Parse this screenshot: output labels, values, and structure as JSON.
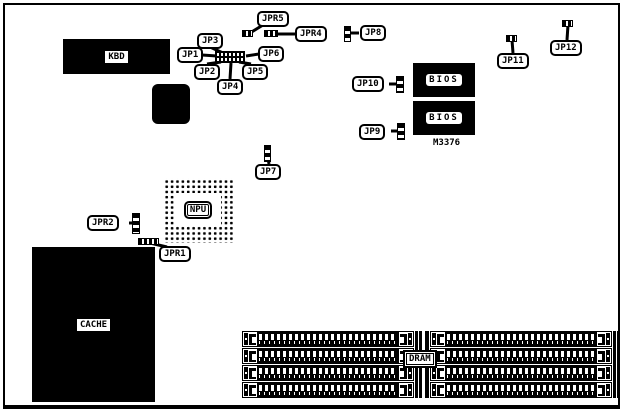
{
  "board": {
    "part_number": "M3376",
    "chips": {
      "kbd": "KBD",
      "bios_top": "BIOS",
      "bios_bottom": "BIOS",
      "npu": "NPU",
      "cache": "CACHE",
      "dram": "DRAM"
    },
    "jumpers": {
      "jp1": "JP1",
      "jp2": "JP2",
      "jp3": "JP3",
      "jp4": "JP4",
      "jp5": "JP5",
      "jp6": "JP6",
      "jp7": "JP7",
      "jp8": "JP8",
      "jp9": "JP9",
      "jp10": "JP10",
      "jp11": "JP11",
      "jp12": "JP12",
      "jpr1": "JPR1",
      "jpr2": "JPR2",
      "jpr4": "JPR4",
      "jpr5": "JPR5"
    }
  }
}
